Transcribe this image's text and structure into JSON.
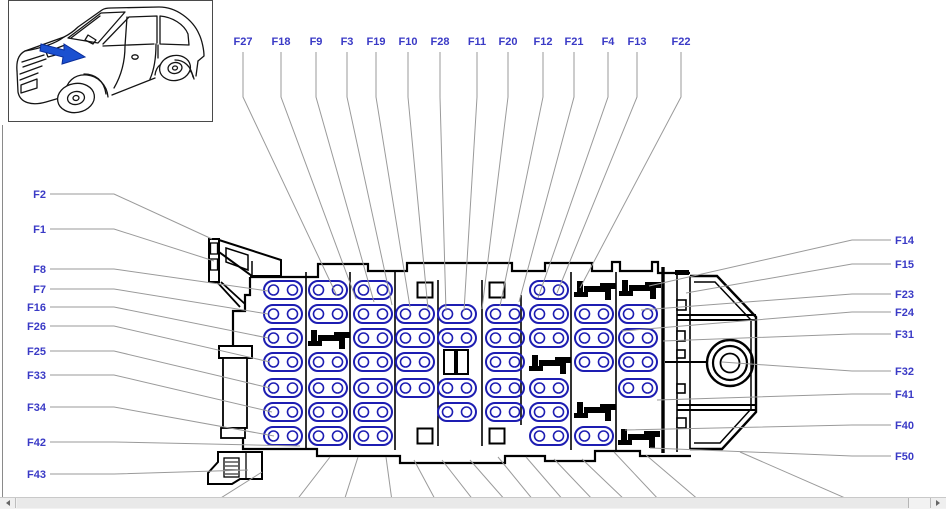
{
  "window": {
    "background": "#ffffff",
    "scrollbar": {
      "orientation": "horizontal"
    }
  },
  "colors": {
    "fuse_outline": "#1d1db2",
    "label_text": "#3a3ac6",
    "leader_line": "#9a9a9a",
    "housing_line": "#000000",
    "arrow_fill": "#1b50d0",
    "arrow_stroke": "#0a2d9a"
  },
  "diagram": {
    "top_labels": [
      {
        "text": "F27",
        "x": 243,
        "tx": 337,
        "ty": 296
      },
      {
        "text": "F18",
        "x": 281,
        "tx": 356,
        "ty": 299
      },
      {
        "text": "F9",
        "x": 316,
        "tx": 374,
        "ty": 302
      },
      {
        "text": "F3",
        "x": 347,
        "tx": 392,
        "ty": 305
      },
      {
        "text": "F19",
        "x": 376,
        "tx": 410,
        "ty": 307
      },
      {
        "text": "F10",
        "x": 408,
        "tx": 428,
        "ty": 309
      },
      {
        "text": "F28",
        "x": 440,
        "tx": 446,
        "ty": 311
      },
      {
        "text": "F11",
        "x": 477,
        "tx": 464,
        "ty": 311
      },
      {
        "text": "F20",
        "x": 508,
        "tx": 482,
        "ty": 309
      },
      {
        "text": "F12",
        "x": 543,
        "tx": 500,
        "ty": 306
      },
      {
        "text": "F21",
        "x": 574,
        "tx": 519,
        "ty": 302
      },
      {
        "text": "F4",
        "x": 608,
        "tx": 538,
        "ty": 298
      },
      {
        "text": "F13",
        "x": 637,
        "tx": 557,
        "ty": 293
      },
      {
        "text": "F22",
        "x": 681,
        "tx": 580,
        "ty": 288
      }
    ],
    "left_labels": [
      {
        "text": "F2",
        "y": 194,
        "tx": 212,
        "ty": 239
      },
      {
        "text": "F1",
        "y": 229,
        "tx": 214,
        "ty": 261
      },
      {
        "text": "F8",
        "y": 269,
        "tx": 268,
        "ty": 291
      },
      {
        "text": "F7",
        "y": 289,
        "tx": 268,
        "ty": 314
      },
      {
        "text": "F16",
        "y": 307,
        "tx": 268,
        "ty": 338
      },
      {
        "text": "F26",
        "y": 326,
        "tx": 270,
        "ty": 362
      },
      {
        "text": "F25",
        "y": 351,
        "tx": 270,
        "ty": 388
      },
      {
        "text": "F33",
        "y": 375,
        "tx": 272,
        "ty": 412
      },
      {
        "text": "F34",
        "y": 407,
        "tx": 274,
        "ty": 436
      },
      {
        "text": "F42",
        "y": 442,
        "tx": 300,
        "ty": 446
      },
      {
        "text": "F43",
        "y": 474,
        "tx": 248,
        "ty": 470
      }
    ],
    "right_labels": [
      {
        "text": "F14",
        "y": 240,
        "tx": 649,
        "ty": 286
      },
      {
        "text": "F15",
        "y": 264,
        "tx": 686,
        "ty": 293
      },
      {
        "text": "F23",
        "y": 294,
        "tx": 641,
        "ty": 310
      },
      {
        "text": "F24",
        "y": 312,
        "tx": 622,
        "ty": 331
      },
      {
        "text": "F31",
        "y": 334,
        "tx": 663,
        "ty": 341
      },
      {
        "text": "F32",
        "y": 371,
        "tx": 722,
        "ty": 362
      },
      {
        "text": "F41",
        "y": 394,
        "tx": 657,
        "ty": 400
      },
      {
        "text": "F40",
        "y": 425,
        "tx": 625,
        "ty": 430
      },
      {
        "text": "F50",
        "y": 456,
        "tx": 650,
        "ty": 448
      }
    ],
    "bottom_lines": [
      {
        "x1": 262,
        "y1": 472,
        "x2": 216,
        "y2": 501
      },
      {
        "x1": 330,
        "y1": 457,
        "x2": 296,
        "y2": 501
      },
      {
        "x1": 358,
        "y1": 457,
        "x2": 344,
        "y2": 501
      },
      {
        "x1": 386,
        "y1": 457,
        "x2": 392,
        "y2": 501
      },
      {
        "x1": 414,
        "y1": 460,
        "x2": 436,
        "y2": 501
      },
      {
        "x1": 442,
        "y1": 460,
        "x2": 474,
        "y2": 501
      },
      {
        "x1": 470,
        "y1": 460,
        "x2": 506,
        "y2": 501
      },
      {
        "x1": 498,
        "y1": 457,
        "x2": 534,
        "y2": 501
      },
      {
        "x1": 526,
        "y1": 457,
        "x2": 564,
        "y2": 501
      },
      {
        "x1": 554,
        "y1": 459,
        "x2": 594,
        "y2": 501
      },
      {
        "x1": 582,
        "y1": 459,
        "x2": 626,
        "y2": 501
      },
      {
        "x1": 614,
        "y1": 452,
        "x2": 660,
        "y2": 501
      },
      {
        "x1": 646,
        "y1": 455,
        "x2": 700,
        "y2": 501
      },
      {
        "x1": 740,
        "y1": 452,
        "x2": 852,
        "y2": 501
      }
    ],
    "grid": [
      {
        "t": "f",
        "x": 283,
        "y": 290
      },
      {
        "t": "f",
        "x": 283,
        "y": 314
      },
      {
        "t": "f",
        "x": 283,
        "y": 338
      },
      {
        "t": "f",
        "x": 283,
        "y": 362
      },
      {
        "t": "f",
        "x": 283,
        "y": 388
      },
      {
        "t": "f",
        "x": 283,
        "y": 412
      },
      {
        "t": "f",
        "x": 283,
        "y": 436
      },
      {
        "t": "f",
        "x": 328,
        "y": 290
      },
      {
        "t": "f",
        "x": 328,
        "y": 314
      },
      {
        "t": "r",
        "x": 328,
        "y": 338
      },
      {
        "t": "f",
        "x": 328,
        "y": 362
      },
      {
        "t": "f",
        "x": 328,
        "y": 388
      },
      {
        "t": "f",
        "x": 328,
        "y": 412
      },
      {
        "t": "f",
        "x": 328,
        "y": 436
      },
      {
        "t": "f",
        "x": 373,
        "y": 290
      },
      {
        "t": "f",
        "x": 373,
        "y": 314
      },
      {
        "t": "f",
        "x": 373,
        "y": 338
      },
      {
        "t": "f",
        "x": 373,
        "y": 362
      },
      {
        "t": "f",
        "x": 373,
        "y": 388
      },
      {
        "t": "f",
        "x": 373,
        "y": 412
      },
      {
        "t": "f",
        "x": 373,
        "y": 436
      },
      {
        "t": "f",
        "x": 415,
        "y": 314
      },
      {
        "t": "f",
        "x": 415,
        "y": 338
      },
      {
        "t": "f",
        "x": 415,
        "y": 362
      },
      {
        "t": "f",
        "x": 415,
        "y": 388
      },
      {
        "t": "f",
        "x": 457,
        "y": 314
      },
      {
        "t": "f",
        "x": 457,
        "y": 338
      },
      {
        "t": "d",
        "x": 456,
        "y": 362
      },
      {
        "t": "f",
        "x": 457,
        "y": 388
      },
      {
        "t": "f",
        "x": 457,
        "y": 412
      },
      {
        "t": "f",
        "x": 505,
        "y": 314
      },
      {
        "t": "f",
        "x": 505,
        "y": 338
      },
      {
        "t": "f",
        "x": 505,
        "y": 362
      },
      {
        "t": "f",
        "x": 505,
        "y": 388
      },
      {
        "t": "f",
        "x": 505,
        "y": 412
      },
      {
        "t": "f",
        "x": 549,
        "y": 290
      },
      {
        "t": "f",
        "x": 549,
        "y": 314
      },
      {
        "t": "f",
        "x": 549,
        "y": 338
      },
      {
        "t": "r",
        "x": 549,
        "y": 363
      },
      {
        "t": "f",
        "x": 549,
        "y": 388
      },
      {
        "t": "f",
        "x": 549,
        "y": 412
      },
      {
        "t": "f",
        "x": 549,
        "y": 436
      },
      {
        "t": "r",
        "x": 594,
        "y": 289
      },
      {
        "t": "f",
        "x": 594,
        "y": 314
      },
      {
        "t": "f",
        "x": 594,
        "y": 338
      },
      {
        "t": "f",
        "x": 594,
        "y": 362
      },
      {
        "t": "r",
        "x": 594,
        "y": 410
      },
      {
        "t": "f",
        "x": 594,
        "y": 436
      },
      {
        "t": "r",
        "x": 639,
        "y": 288
      },
      {
        "t": "f",
        "x": 638,
        "y": 314
      },
      {
        "t": "f",
        "x": 638,
        "y": 338
      },
      {
        "t": "f",
        "x": 638,
        "y": 362
      },
      {
        "t": "f",
        "x": 638,
        "y": 388
      },
      {
        "t": "r",
        "x": 638,
        "y": 437
      },
      {
        "t": "s",
        "x": 425,
        "y": 290
      },
      {
        "t": "s",
        "x": 497,
        "y": 290
      },
      {
        "t": "s",
        "x": 425,
        "y": 436
      },
      {
        "t": "s",
        "x": 497,
        "y": 436
      }
    ]
  }
}
